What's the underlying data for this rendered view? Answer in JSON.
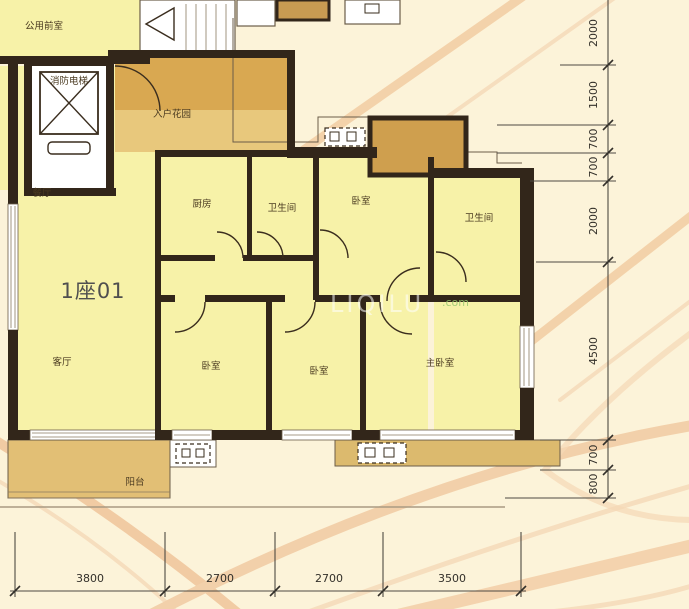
{
  "unit": {
    "label": "1座01"
  },
  "rooms": {
    "public_lobby": {
      "label": "公用前室"
    },
    "fire_elevator": {
      "label": "消防电梯"
    },
    "entry_garden": {
      "label": "入户花园"
    },
    "dining": {
      "label": "餐厅"
    },
    "living": {
      "label": "客厅"
    },
    "kitchen": {
      "label": "厨房"
    },
    "bath_top": {
      "label": "卫生间"
    },
    "bath_right": {
      "label": "卫生间"
    },
    "bedroom_top": {
      "label": "卧室"
    },
    "bedroom_left": {
      "label": "卧室"
    },
    "bedroom_mid": {
      "label": "卧室"
    },
    "master_bedroom": {
      "label": "主卧室"
    },
    "balcony": {
      "label": "阳台"
    }
  },
  "watermark": {
    "text": "LIQILU",
    "suffix": ".com"
  },
  "dimensions": {
    "right": [
      "2000",
      "1500",
      "700",
      "700",
      "2000",
      "4500",
      "700",
      "800"
    ],
    "bottom": [
      "3800",
      "2700",
      "2700",
      "3500"
    ]
  },
  "colors": {
    "background": "#fcf3d9",
    "room_fill": "#f7f2a8",
    "garden_dark": "#d9a851",
    "garden_light": "#e8c87c",
    "balcony_fill": "#e2bf75",
    "bay_fill": "#dcba6e",
    "wall": "#32261a",
    "deco_peach": "#f2cda6"
  }
}
